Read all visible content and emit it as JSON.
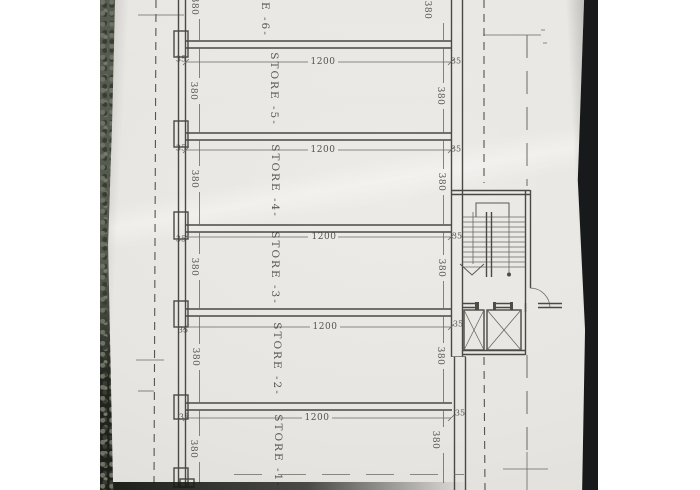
{
  "photo": {
    "description_colors": {
      "table_left": "#565b50",
      "table_right": "#17191b",
      "paper": "#e8e6e2"
    }
  },
  "plan": {
    "rooms": [
      {
        "id": "store-6",
        "label": "STORE -6-",
        "depth_left": "380",
        "depth_right": "380"
      },
      {
        "id": "store-5",
        "label": "STORE -5-",
        "width_label": "1200",
        "depth_left": "380",
        "depth_right": "380"
      },
      {
        "id": "store-4",
        "label": "STORE -4-",
        "width_label": "1200",
        "depth_left": "380",
        "depth_right": "380"
      },
      {
        "id": "store-3",
        "label": "STORE -3-",
        "width_label": "1200",
        "depth_left": "380",
        "depth_right": "380"
      },
      {
        "id": "store-2",
        "label": "STORE -2-",
        "width_label": "1200",
        "depth_left": "380",
        "depth_right": "380"
      },
      {
        "id": "store-1",
        "label": "STORE -1-",
        "width_label": "1200",
        "depth_left": "380",
        "depth_right": "380"
      }
    ],
    "wall_labels": [
      {
        "left": "35",
        "right": "35"
      },
      {
        "left": "35",
        "right": "35"
      },
      {
        "left": "35",
        "right": "35"
      },
      {
        "left": "35",
        "right": "35"
      },
      {
        "left": "35",
        "right": "35"
      }
    ]
  }
}
